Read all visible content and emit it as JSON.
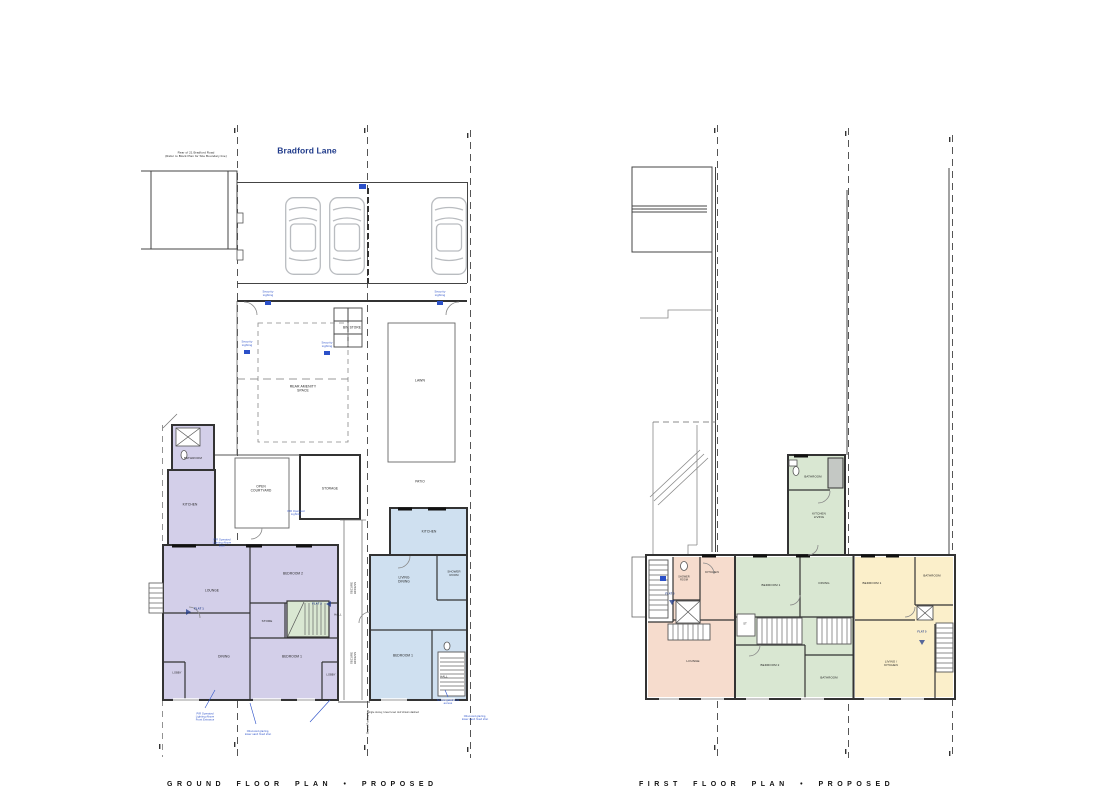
{
  "sheet": {
    "type": "architectural floor plans",
    "street_name": "Bradford Lane"
  },
  "captions": {
    "ground": "GROUND FLOOR PLAN  •  PROPOSED",
    "first": "FIRST FLOOR PLAN  •  PROPOSED"
  },
  "colors": {
    "flat1": "#d3cfe9",
    "flat2": "#cfe0f0",
    "flat3": "#f6dccd",
    "flat4": "#d9e7d2",
    "flat5": "#fbefca",
    "ann": "#2b50c8",
    "navy": "#1f3a8a",
    "wall": "#333333",
    "thin": "#555555",
    "car": "#b9bcc0"
  },
  "ground_floor": {
    "labels": [
      {
        "name": "street-label",
        "text": "Bradford Lane",
        "x": 307,
        "y": 151,
        "size": 8.5,
        "color": "navy"
      },
      {
        "text": "Rear of 21 Bradford Road\n(Refer to Block Plan for Site Boundary line)",
        "x": 196,
        "y": 155,
        "size": 3
      },
      {
        "text": "Security\nLighting",
        "x": 268,
        "y": 294,
        "size": 2.8,
        "color": "blue"
      },
      {
        "text": "Security\nLighting",
        "x": 440,
        "y": 294,
        "size": 2.8,
        "color": "blue"
      },
      {
        "text": "Security\nLighting",
        "x": 247,
        "y": 344,
        "size": 2.8,
        "color": "blue"
      },
      {
        "text": "Security\nLighting",
        "x": 327,
        "y": 345,
        "size": 2.8,
        "color": "blue"
      },
      {
        "text": "BIN STORE",
        "x": 352,
        "y": 328,
        "size": 3.2
      },
      {
        "text": "REAR AMENITY\nSPACE",
        "x": 303,
        "y": 389,
        "size": 3.4
      },
      {
        "text": "LAWN",
        "x": 420,
        "y": 381,
        "size": 3.4
      },
      {
        "text": "OPEN\nCOURTYARD",
        "x": 261,
        "y": 489,
        "size": 3.2
      },
      {
        "text": "STORAGE",
        "x": 330,
        "y": 489,
        "size": 3.2
      },
      {
        "text": "PATIO",
        "x": 420,
        "y": 482,
        "size": 3.2
      },
      {
        "text": "BATHROOM",
        "x": 193,
        "y": 459,
        "size": 3
      },
      {
        "text": "KITCHEN",
        "x": 190,
        "y": 505,
        "size": 3.2
      },
      {
        "text": "LOUNGE",
        "x": 212,
        "y": 591,
        "size": 3.2
      },
      {
        "text": "BEDROOM 2",
        "x": 293,
        "y": 574,
        "size": 3.2
      },
      {
        "text": "STORE",
        "x": 267,
        "y": 622,
        "size": 3
      },
      {
        "text": "DINING",
        "x": 224,
        "y": 657,
        "size": 3.2
      },
      {
        "text": "BEDROOM 1",
        "x": 292,
        "y": 657,
        "size": 3.2
      },
      {
        "text": "FLAT 1",
        "x": 199,
        "y": 609,
        "size": 2.8,
        "color": "navy"
      },
      {
        "text": "FLAT 2",
        "x": 317,
        "y": 604,
        "size": 2.8,
        "color": "navy"
      },
      {
        "text": "HALL",
        "x": 338,
        "y": 615,
        "size": 2.8
      },
      {
        "text": "LOBBY",
        "x": 177,
        "y": 673,
        "size": 2.6
      },
      {
        "text": "LOBBY",
        "x": 331,
        "y": 675,
        "size": 2.6
      },
      {
        "text": "KITCHEN",
        "x": 429,
        "y": 532,
        "size": 3.2
      },
      {
        "text": "LIVING\nDINING",
        "x": 404,
        "y": 580,
        "size": 3.2
      },
      {
        "text": "SHOWER\nROOM",
        "x": 454,
        "y": 574,
        "size": 2.8
      },
      {
        "text": "BEDROOM 1",
        "x": 403,
        "y": 656,
        "size": 3.2
      },
      {
        "text": "HALL",
        "x": 444,
        "y": 677,
        "size": 2.8
      },
      {
        "text": "SECURE\nACCESS",
        "x": 354,
        "y": 588,
        "size": 2.8,
        "rot": -90
      },
      {
        "text": "SECURE\nACCESS",
        "x": 354,
        "y": 658,
        "size": 2.8,
        "rot": -90
      },
      {
        "text": "Shared Parking bay",
        "x": 368,
        "y": 722,
        "size": 2.6,
        "rot": -90
      },
      {
        "text": "PIR Operated\nLighting Above\nDoor",
        "x": 222,
        "y": 543,
        "size": 2.6,
        "color": "blue"
      },
      {
        "text": "PIR Operated\nLighting",
        "x": 296,
        "y": 513,
        "size": 2.6,
        "color": "blue"
      },
      {
        "text": "PIR Operated\nLighting Above\nFront Entrance",
        "x": 205,
        "y": 717,
        "size": 2.6,
        "color": "blue"
      },
      {
        "text": "Obscured glazing,\nlower sash fixed shut",
        "x": 258,
        "y": 733,
        "size": 2.6,
        "color": "blue"
      },
      {
        "text": "Secure gated side\naccess",
        "x": 448,
        "y": 702,
        "size": 2.6,
        "color": "blue"
      },
      {
        "text": "Obscured glazing,\nlower sash fixed shut",
        "x": 475,
        "y": 718,
        "size": 2.6,
        "color": "blue"
      },
      {
        "text": "Single storey, lower level roof shown dashed",
        "x": 393,
        "y": 713,
        "size": 2.4
      }
    ]
  },
  "first_floor": {
    "labels": [
      {
        "text": "BATHROOM",
        "x": 813,
        "y": 477,
        "size": 2.9
      },
      {
        "text": "KITCHEN\nLIVING",
        "x": 819,
        "y": 516,
        "size": 3
      },
      {
        "text": "KITCHEN",
        "x": 712,
        "y": 573,
        "size": 3
      },
      {
        "text": "SHOWER\nROOM",
        "x": 684,
        "y": 579,
        "size": 2.4
      },
      {
        "text": "FLAT 3",
        "x": 670,
        "y": 594,
        "size": 2.6,
        "color": "navy"
      },
      {
        "text": "LOUNGE",
        "x": 693,
        "y": 662,
        "size": 3
      },
      {
        "text": "BEDROOM 1",
        "x": 771,
        "y": 586,
        "size": 3
      },
      {
        "text": "DINING",
        "x": 824,
        "y": 584,
        "size": 3
      },
      {
        "text": "ST",
        "x": 745,
        "y": 624,
        "size": 2.6
      },
      {
        "text": "BEDROOM 2",
        "x": 770,
        "y": 666,
        "size": 3
      },
      {
        "text": "BATHROOM",
        "x": 829,
        "y": 678,
        "size": 2.9
      },
      {
        "text": "BEDROOM 1",
        "x": 872,
        "y": 584,
        "size": 3
      },
      {
        "text": "BATHROOM",
        "x": 932,
        "y": 576,
        "size": 2.9
      },
      {
        "text": "LIVING /\nKITCHEN",
        "x": 891,
        "y": 664,
        "size": 3
      },
      {
        "text": "FLAT 5",
        "x": 922,
        "y": 632,
        "size": 2.6,
        "color": "navy"
      }
    ]
  }
}
